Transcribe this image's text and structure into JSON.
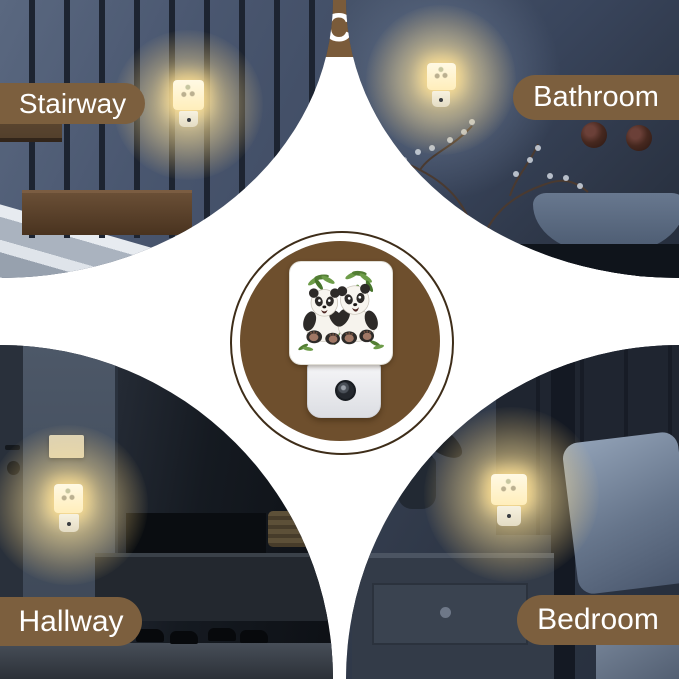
{
  "header": {
    "title": "USAGE SCENARIOS"
  },
  "scenes": [
    {
      "id": "stairway",
      "label": "Stairway"
    },
    {
      "id": "bathroom",
      "label": "Bathroom"
    },
    {
      "id": "hallway",
      "label": "Hallway"
    },
    {
      "id": "bedroom",
      "label": "Bedroom"
    }
  ],
  "colors": {
    "banner_brown": "#7a5b3a",
    "label_pill_brown": "#7c5f3e",
    "center_disc_brown": "#6e4f2d",
    "ring_outline": "#3e2d19",
    "night_light_glow": "#ffe9b2"
  },
  "center_product": {
    "artwork": "pandas-with-bamboo",
    "parts": [
      "glass-panel",
      "plug-base",
      "light-sensor"
    ]
  }
}
